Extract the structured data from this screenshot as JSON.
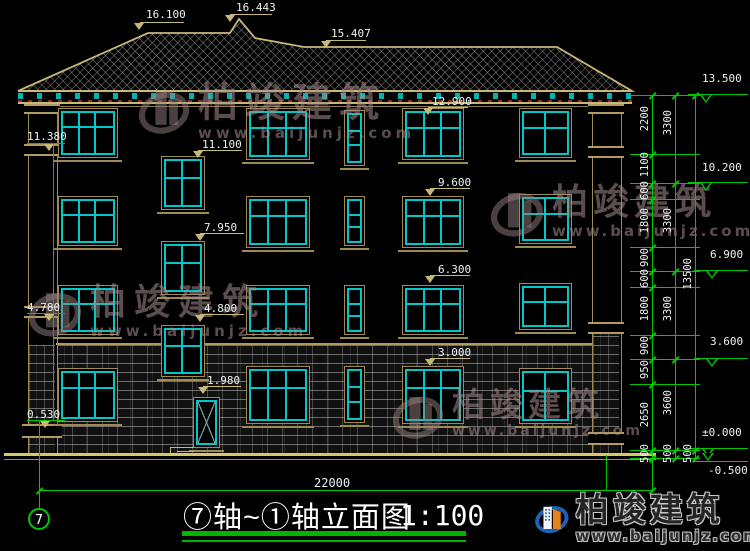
{
  "drawing": {
    "title": "⑦轴~①轴立面图",
    "scale": "1:100",
    "axis_start_bubble": "7",
    "overall_width_dim": "22000"
  },
  "roof_labels": {
    "left_ridge": "16.100",
    "peak": "16.443",
    "right_ridge": "15.407"
  },
  "face_labels": {
    "win4_head": "12.900",
    "stair4_head": "11.100",
    "win3_head": "9.600",
    "stair3_head": "7.950",
    "win2_head": "6.300",
    "stair2_head": "4.800",
    "win1_head": "3.000",
    "door_head": "1.980"
  },
  "left_levels": {
    "parapet": "11.380",
    "mid": "4.780",
    "base": "0.530"
  },
  "right_levels": {
    "roof": "13.500",
    "f4": "10.200",
    "f3": "6.900",
    "f2": "3.600",
    "ground": "±0.000",
    "below": "-0.500"
  },
  "dim_chain_inner": [
    "2200",
    "1100",
    "600",
    "1800",
    "900",
    "600",
    "1800",
    "900",
    "950",
    "2650",
    "500"
  ],
  "dim_chain_mid": [
    "3300",
    "3300",
    "3300",
    "3600",
    "500"
  ],
  "dim_chain_outer": [
    "13500",
    "500"
  ],
  "watermark": {
    "brand": "柏竣建筑",
    "url": "www.baijunjz.com"
  },
  "logo": {
    "brand": "柏竣建筑",
    "url": "www.baijunjz.com"
  },
  "colors": {
    "green": "#00c800",
    "cyan": "#00c8c8",
    "tan": "#c8b878",
    "text": "#f0f0f0",
    "logo_blue": "#1c63b7",
    "logo_orange": "#e8821e",
    "background": "#000000"
  }
}
